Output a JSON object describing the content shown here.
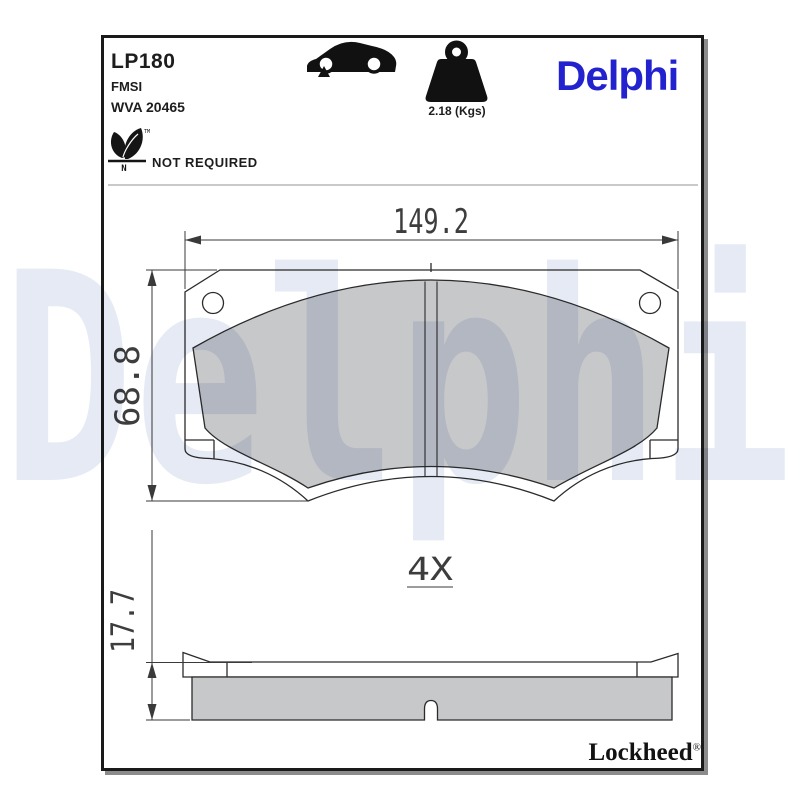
{
  "header": {
    "part_number": "LP180",
    "fmsi": "FMSI",
    "wva": "WVA 20465",
    "eco": {
      "note": "NOT REQUIRED",
      "n": "N",
      "tm": "TM"
    },
    "weight": "2.18 (Kgs)",
    "logo": "Delphi"
  },
  "icons": {
    "vehicle": "car-side-icon",
    "axle_marker": "front-axle-marker-icon",
    "mass": "weight-icon",
    "eco": "eco-leaf-icon"
  },
  "watermark": {
    "text": "Delphi"
  },
  "dims": {
    "width": "149.2",
    "height": "68.8",
    "thickness": "17.7",
    "quantity": "4X"
  },
  "footer": {
    "brand": "Lockheed",
    "reg": "®"
  },
  "colors": {
    "brand_blue": "#2222cf",
    "watermark_blue": "#e6eaf4",
    "friction_gray": "#c7c8ca",
    "line_dark": "#2b2b2b"
  }
}
